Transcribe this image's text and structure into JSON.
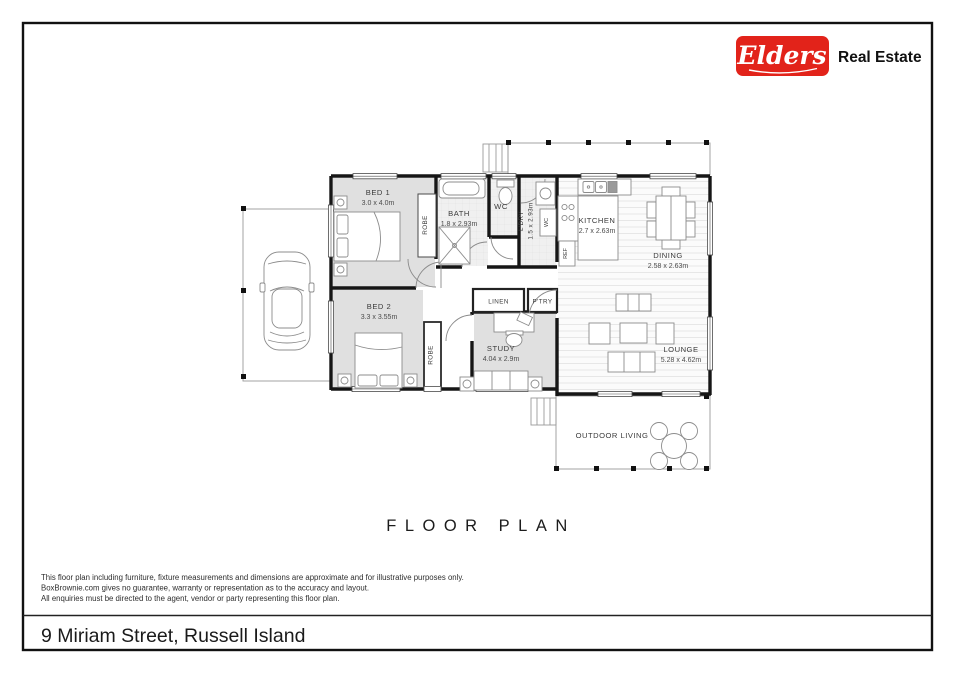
{
  "brand": {
    "logo_text": "Elders",
    "tagline": "Real Estate",
    "logo_bg": "#e2231a"
  },
  "plan": {
    "title": "FLOOR PLAN",
    "rooms": {
      "bed1": {
        "name": "BED 1",
        "dims": "3.0 x 4.0m"
      },
      "bath": {
        "name": "BATH",
        "dims": "1.8 x 2.93m"
      },
      "wc": {
        "name": "WC"
      },
      "ldry": {
        "name": "L'DRY",
        "dims": "1.5 x 2.93m"
      },
      "kitchen": {
        "name": "KITCHEN",
        "dims": "2.7 x 2.63m"
      },
      "dining": {
        "name": "DINING",
        "dims": "2.58 x 2.63m"
      },
      "bed2": {
        "name": "BED 2",
        "dims": "3.3 x 3.55m"
      },
      "linen": {
        "name": "LINEN"
      },
      "ptry": {
        "name": "P'TRY"
      },
      "study": {
        "name": "STUDY",
        "dims": "4.04 x 2.9m"
      },
      "lounge": {
        "name": "LOUNGE",
        "dims": "5.28 x 4.62m"
      },
      "outdoor": {
        "name": "OUTDOOR LIVING"
      },
      "robe1": {
        "name": "ROBE"
      },
      "robe2": {
        "name": "ROBE"
      },
      "ref": {
        "name": "REF"
      },
      "wm": {
        "name": "WC"
      }
    }
  },
  "disclaimer": {
    "line1": "This floor plan including furniture, fixture measurements and dimensions are approximate and for illustrative purposes only.",
    "line2": "BoxBrownie.com gives no guarantee, warranty or representation as to the accuracy and layout.",
    "line3": "All enquiries must be directed to the agent, vendor or party representing this floor plan."
  },
  "address": "9 Miriam Street, Russell Island"
}
